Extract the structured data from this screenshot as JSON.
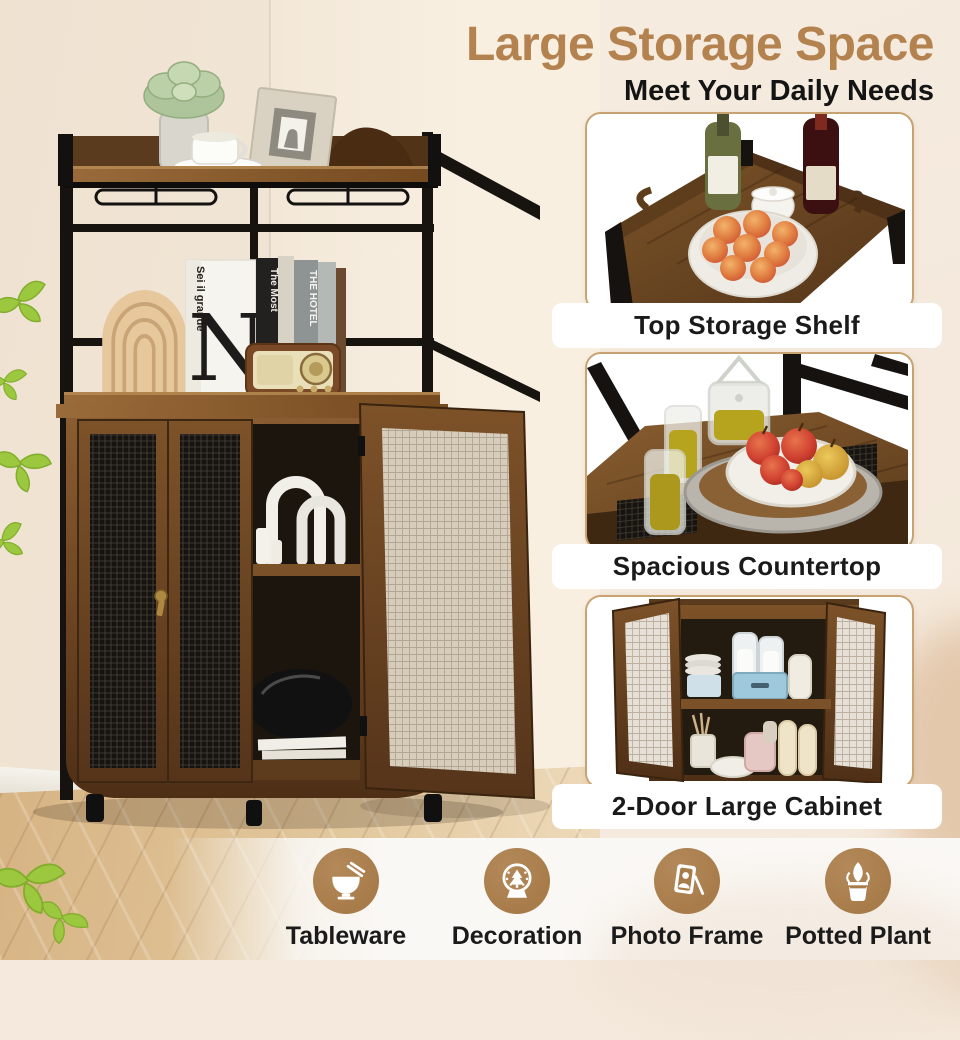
{
  "title": {
    "heading": "Large Storage Space",
    "subheading": "Meet Your Daily Needs"
  },
  "colors": {
    "heading_text": "#b3824f",
    "subheading_text": "#141414",
    "card_border": "#c8a371",
    "caption_text": "#1a1a1a",
    "feature_badge": "#a87c4a",
    "feature_label": "#1b1b1b",
    "rustic_wood": "#7a5128",
    "metal_frame": "#17130f",
    "floor_wood": "#dcbc92",
    "leaf_green": "#9cc83f",
    "background_cream": "#f4e9dc"
  },
  "insets": [
    {
      "caption": "Top Storage Shelf",
      "scene": "top-shelf-photo"
    },
    {
      "caption": "Spacious Countertop",
      "scene": "countertop-photo"
    },
    {
      "caption": "2-Door Large Cabinet",
      "scene": "open-cabinet-photo"
    }
  ],
  "features": [
    {
      "label": "Tableware",
      "icon": "bowl-chopsticks-icon"
    },
    {
      "label": "Decoration",
      "icon": "snow-globe-icon"
    },
    {
      "label": "Photo Frame",
      "icon": "photo-frame-icon"
    },
    {
      "label": "Potted Plant",
      "icon": "potted-plant-icon"
    }
  ],
  "main_photo": {
    "book_cover_letter": "N",
    "book_spine_title": "Sei il grande",
    "book_titles": [
      "The Most",
      "THE HOTEL"
    ]
  }
}
